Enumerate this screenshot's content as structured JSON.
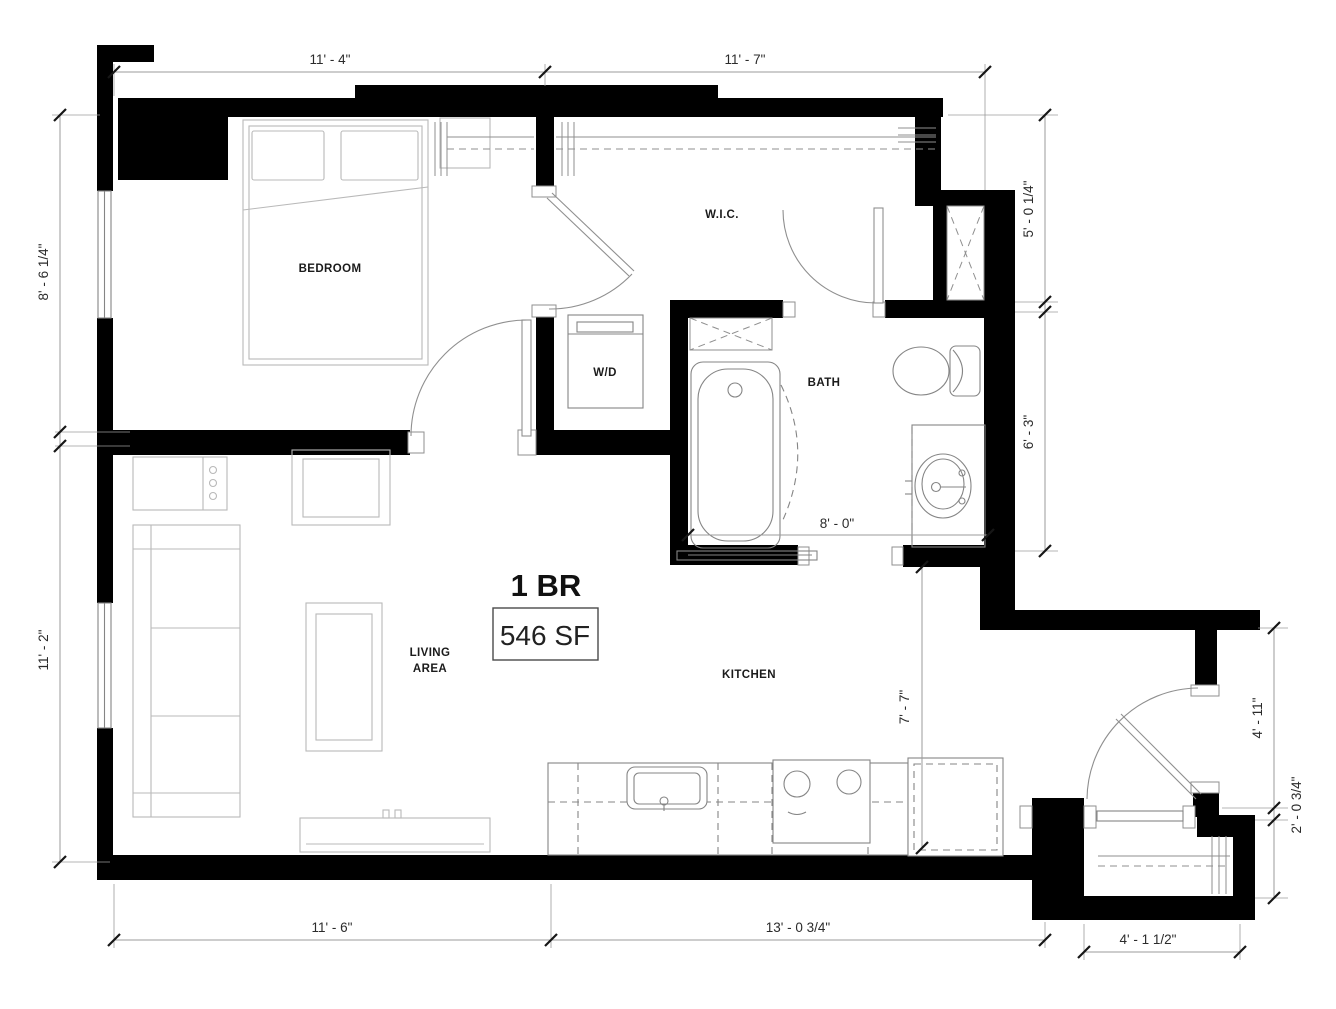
{
  "canvas": {
    "width": 1336,
    "height": 1009,
    "background": "#ffffff",
    "wall_color": "#000000",
    "dimension_line_color": "#9b9b9b",
    "tick_color": "#161616",
    "text_color": "#2b2b2b",
    "furniture_line_color": "#b9b9b9",
    "fixture_line_color": "#858585"
  },
  "plan": {
    "unit_type": "1 BR",
    "unit_area": "546 SF",
    "rooms": {
      "bedroom": "BEDROOM",
      "walk_in_closet": "W.I.C.",
      "washer_dryer": "W/D",
      "bath": "BATH",
      "living_line1": "LIVING",
      "living_line2": "AREA",
      "kitchen": "KITCHEN"
    },
    "dimensions": {
      "top_left": "11' - 4\"",
      "top_right": "11' - 7\"",
      "left_upper": "8' - 6 1/4\"",
      "left_lower": "11' - 2\"",
      "right_wic": "5' - 0 1/4\"",
      "right_bath": "6' - 3\"",
      "right_entry": "4' - 11\"",
      "right_closet": "2' - 0 3/4\"",
      "bottom_left": "11' - 6\"",
      "bottom_middle": "13' - 0 3/4\"",
      "bottom_entry": "4' - 1 1/2\"",
      "bath_interior": "8' - 0\"",
      "kitchen_interior": "7' - 7\""
    }
  }
}
